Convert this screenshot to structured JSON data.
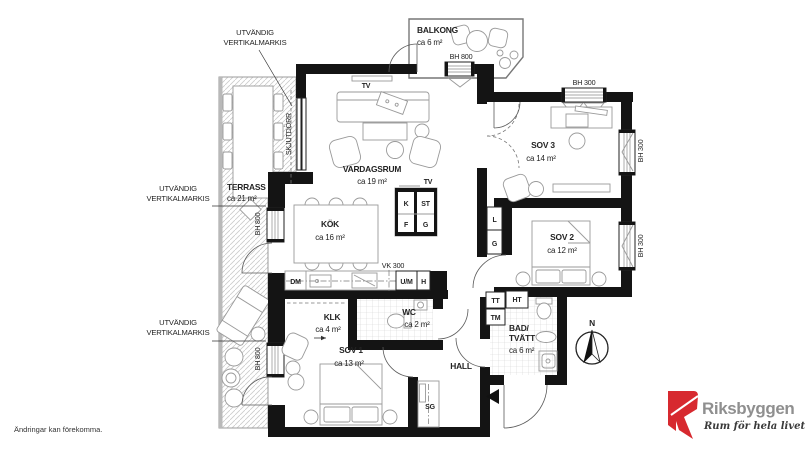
{
  "rooms": {
    "vardagsrum": {
      "name": "VARDAGSRUM",
      "area": "ca 19 m²"
    },
    "kok": {
      "name": "KÖK",
      "area": "ca 16 m²"
    },
    "sov1": {
      "name": "SOV 1",
      "area": "ca 13 m²"
    },
    "sov2": {
      "name": "SOV 2",
      "area": "ca 12 m²"
    },
    "sov3": {
      "name": "SOV 3",
      "area": "ca 14 m²"
    },
    "klk": {
      "name": "KLK",
      "area": "ca 4 m²"
    },
    "wc": {
      "name": "WC",
      "area": "ca 2 m²"
    },
    "bad": {
      "line1": "BAD/",
      "line2": "TVÄTT",
      "area": "ca 6 m²"
    },
    "hall": {
      "name": "HALL"
    },
    "terrass": {
      "name": "TERRASS",
      "area": "ca 21 m²"
    },
    "balkong": {
      "name": "BALKONG",
      "area": "ca 6 m²"
    }
  },
  "windows": {
    "bh800": "BH 800",
    "bh300": "BH 300"
  },
  "labels": {
    "tv": "TV",
    "k": "K",
    "st": "ST",
    "f": "F",
    "g": "G",
    "l": "L",
    "g2": "G",
    "dm": "DM",
    "um": "U/M",
    "h": "H",
    "vk300": "VK 300",
    "tt": "TT",
    "tm": "TM",
    "ht": "HT",
    "sg": "SG",
    "skjutdorr": "SKJUTDÖRR",
    "north": "N"
  },
  "annotations": {
    "awning1": "UTVÄNDIG",
    "awning2": "VERTIKALMARKIS"
  },
  "footer": {
    "disclaimer": "Ändringar kan förekomma."
  },
  "logo": {
    "brand": "Riksbyggen",
    "tagline": "Rum för hela livet"
  },
  "colors": {
    "wall": "#141414",
    "furniture": "#9a9a9a",
    "logo_red": "#d7292f",
    "logo_gray": "#8f8f8f"
  }
}
